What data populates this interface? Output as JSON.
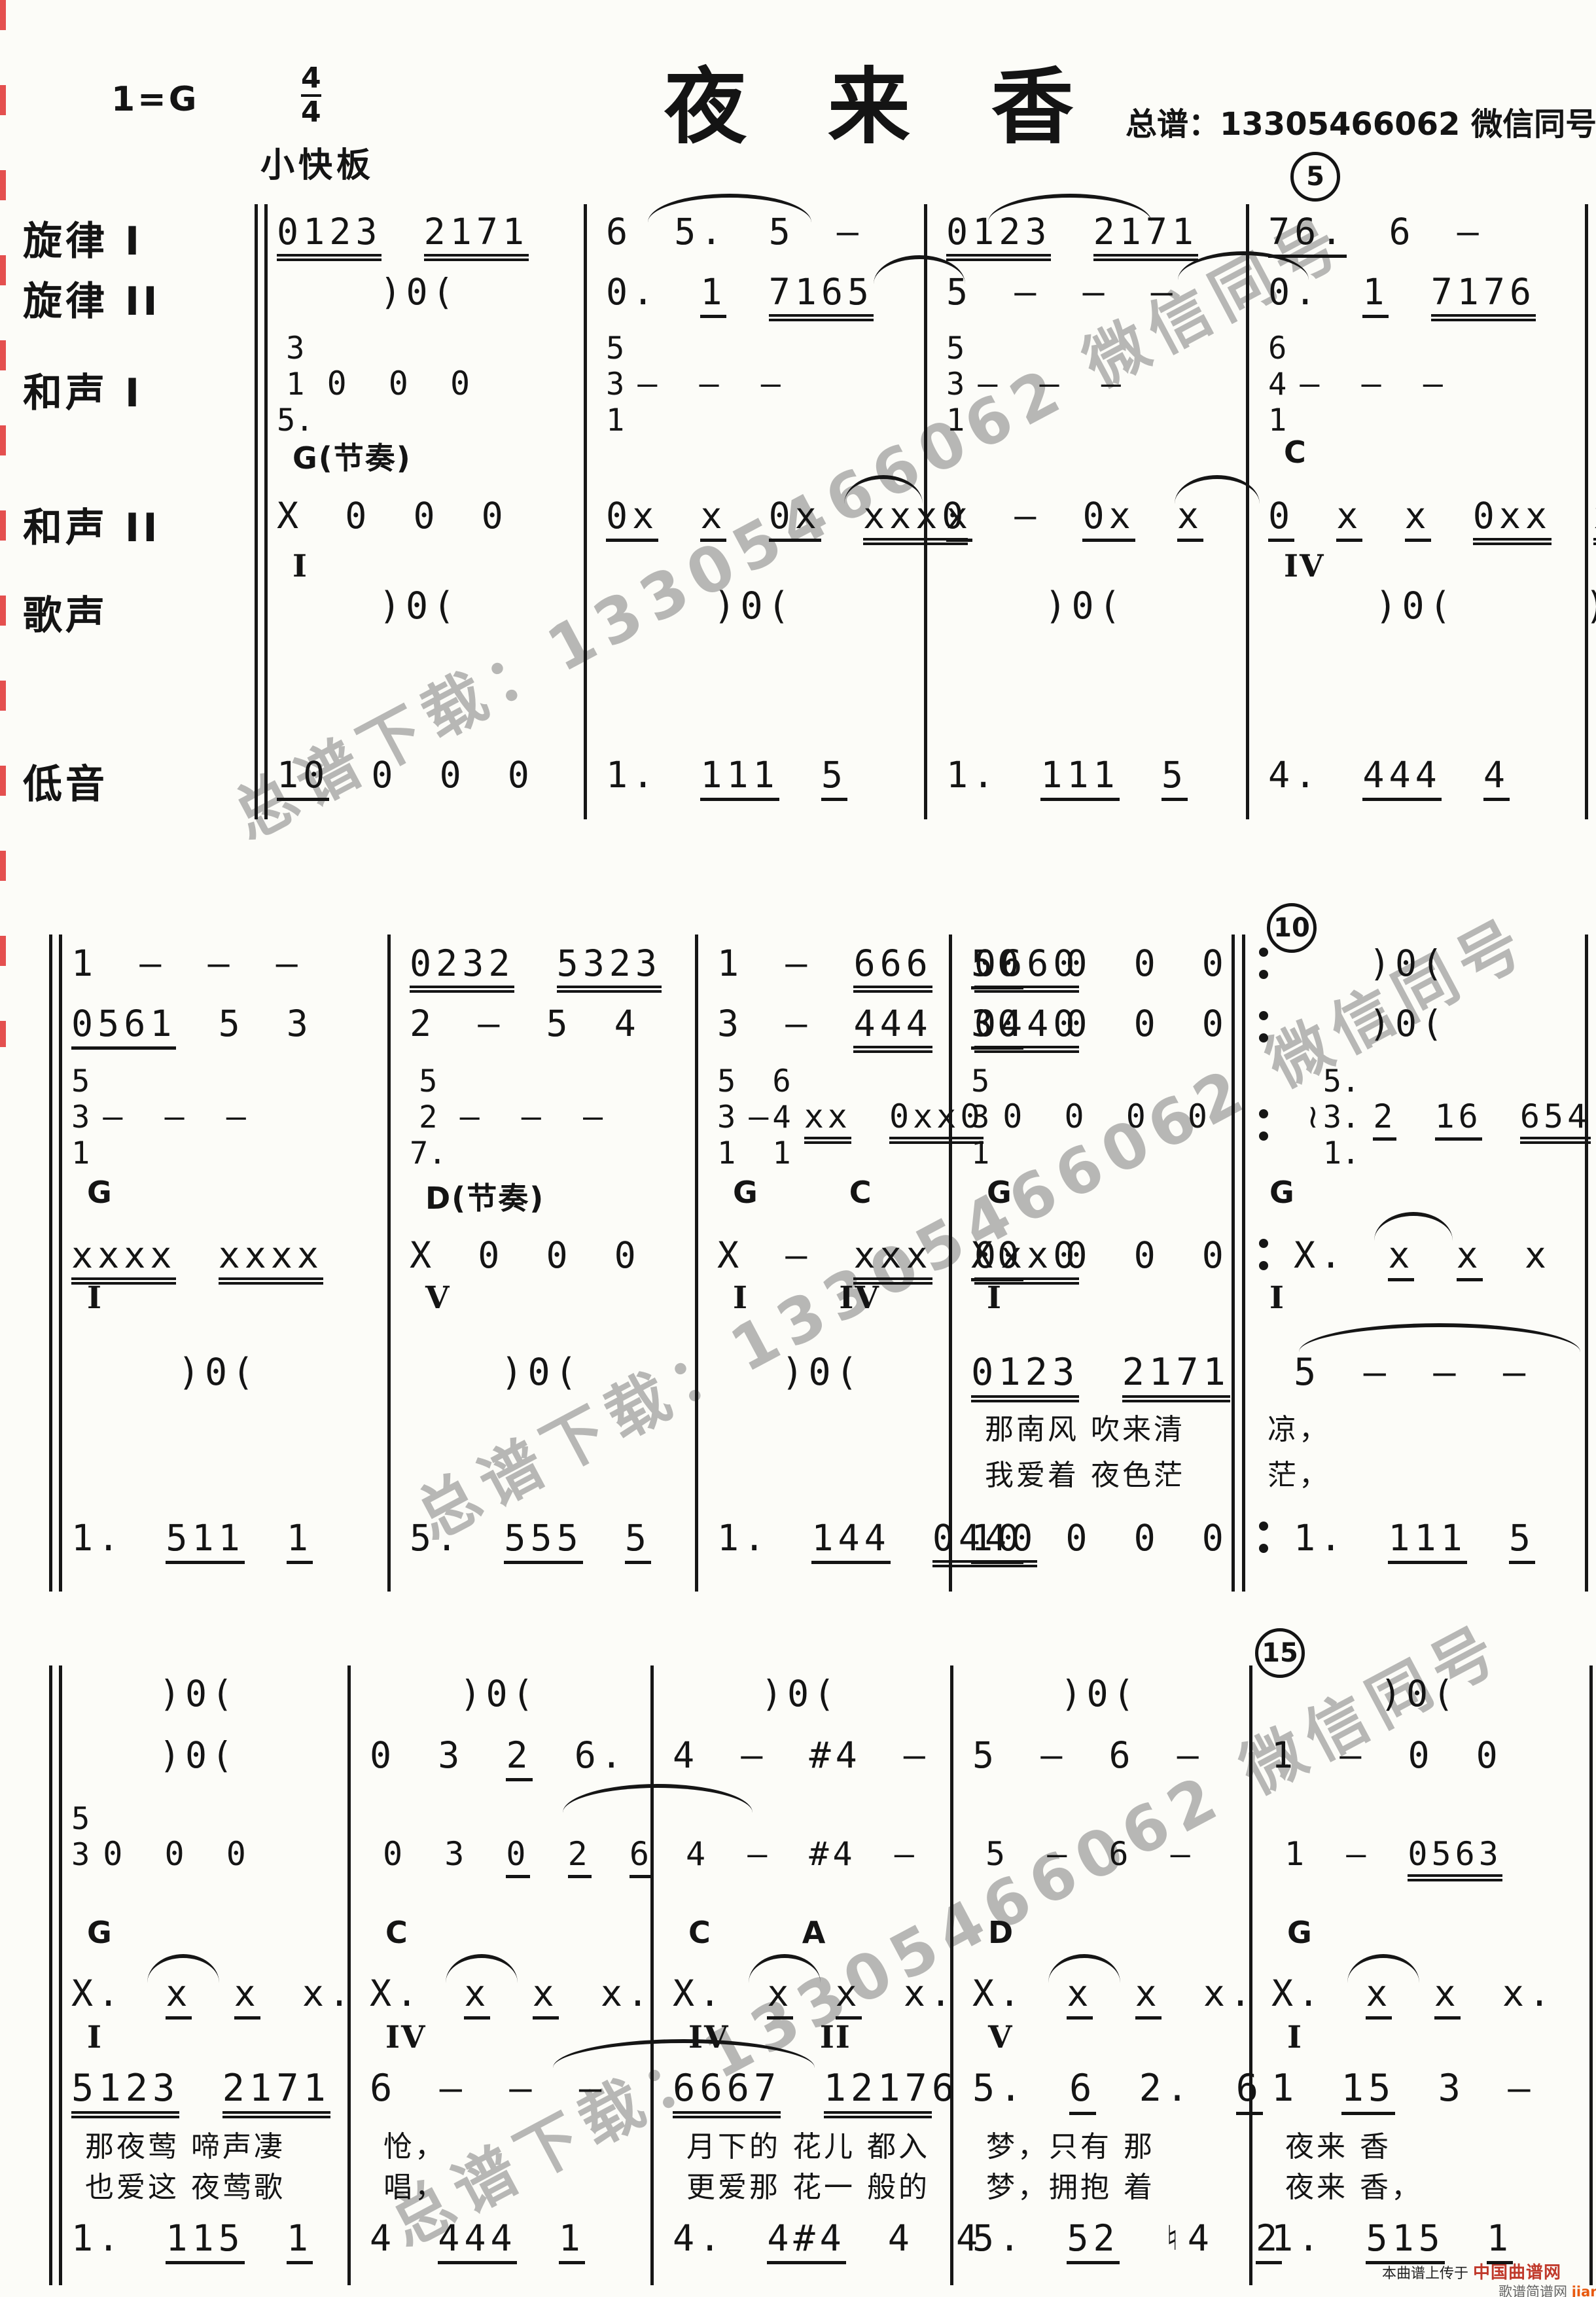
{
  "header": {
    "key": "1=G",
    "time_top": "4",
    "time_bottom": "4",
    "title": "夜 来 香",
    "contact": "总谱：13305466062  微信同号",
    "tempo": "小快板"
  },
  "labels": [
    "旋律 I",
    "旋律 II",
    "和声 I",
    "和声 II",
    "歌声",
    "低音"
  ],
  "measure_numbers": [
    "5",
    "10",
    "15"
  ],
  "watermark": "总谱下载：13305466062 微信同号",
  "footer": {
    "line1": "本曲谱上传于",
    "logo": "中国曲谱网",
    "line2": "歌谱简谱网",
    "site": "jianpu.cn"
  },
  "colors": {
    "ink": "#141414",
    "watermark_gray": "#7d7d7d",
    "artifact_red": "#e03131",
    "site_orange": "#e8590f",
    "logo_red": "#c0392b"
  },
  "systems": [
    {
      "measures": [
        {
          "melody1": "{0123} {2171}",
          "melody2": ")0(",
          "h1": [
            {
              "s": [
                "3",
                "1",
                "5."
              ]
            },
            {
              "t": "0  0  0"
            }
          ],
          "chord": "G(节奏)",
          "harmony2": "X 0 0 0",
          "roman": "I",
          "vocal": ")0(",
          "bass": "[10] 0 0 0"
        },
        {
          "melody1": "6 5. 5 –",
          "melody2": "0. [1] {7165}",
          "h1": [
            {
              "s": [
                "5",
                "3",
                "1"
              ]
            },
            {
              "t": "–  –  –"
            }
          ],
          "harmony2": "[0x] [x] [0x] {xxx0}",
          "vocal": ")0(",
          "bass": "1. [111] [5]"
        },
        {
          "melody1": "{0123} {2171}",
          "melody2": "5 – – –",
          "h1": [
            {
              "s": [
                "5",
                "3",
                "1"
              ]
            },
            {
              "t": "–  –  –"
            }
          ],
          "harmony2": "[x] – [0x] [x]",
          "vocal": ")0(",
          "bass": "1. [111] [5]"
        },
        {
          "melody1": "[76.] 6 –",
          "melody2": "0. [1] {7176}",
          "h1": [
            {
              "s": [
                "6",
                "4",
                "1"
              ]
            },
            {
              "t": "–  –  –"
            }
          ],
          "chord": "C",
          "harmony2": "[0] [x] [x] {0xx} {xxx}",
          "roman": "IV",
          "vocal": ")0(",
          "bass": "4. [444] [4]"
        },
        {
          "melody1": "4 – – –",
          "melody2": "[6246] [2] 6",
          "h1": [
            {
              "s": [
                "4",
                "2",
                "6."
              ]
            },
            {
              "t": "–  –  –"
            }
          ],
          "chord": "Am(分解)",
          "harmony2": "{xxxx} {xxxx}",
          "roman": "IIm",
          "vocal": ")0(",
          "bass": "2. [6222]"
        }
      ]
    },
    {
      "measures": [
        {
          "melody1": "1 – – –",
          "melody2": "[0561] 5 3",
          "h1": [
            {
              "s": [
                "5",
                "3",
                "1"
              ]
            },
            {
              "t": "–  –  –"
            }
          ],
          "chord": "G",
          "harmony2": "{xxxx} {xxxx}",
          "roman": "I",
          "vocal": ")0(",
          "bass": "1. [511] [1]"
        },
        {
          "melody1": "{0232} {5323}",
          "melody2": "2 – 5 4",
          "h1": [
            {
              "s": [
                "5",
                "2",
                "7."
              ]
            },
            {
              "t": "–  –  –"
            }
          ],
          "chord": "D(节奏)",
          "harmony2": "X 0 0 0",
          "roman": "V",
          "vocal": ")0(",
          "bass": "5. [555] [5]"
        },
        {
          "melody1": "1 – {666} {0660}",
          "melody2": "3 – {444} {0440}",
          "h1": [
            {
              "s": [
                "5",
                "3",
                "1"
              ]
            },
            {
              "t": "–"
            },
            {
              "s": [
                "6",
                "4",
                "1"
              ]
            },
            {
              "t": "{xx} {0xx0}"
            }
          ],
          "chord": "G C",
          "harmony2": "X – {xxx} {0xx0}",
          "roman": "I IV",
          "vocal": ")0(",
          "bass": "1. [144] {0440}"
        },
        {
          "melody1": "[50] 0 0 0",
          "melody2": "[30] 0 0 0",
          "h1": [
            {
              "s": [
                "5",
                "3",
                "1"
              ]
            },
            {
              "t": "0 0 0 0"
            }
          ],
          "chord": "G",
          "harmony2": "[X0] 0 0 0",
          "roman": "I",
          "vocal": "{0123} {2171}",
          "lyric1": "那南风 吹来清",
          "lyric2": "我爱着 夜色茫",
          "bass": "[10] 0 0 0"
        },
        {
          "melody1": ")0(",
          "melody2": ")0(",
          "h1": [
            {
              "t": "≀"
            },
            {
              "s": [
                "5.",
                "3.",
                "1."
              ]
            },
            {
              "t": "[2] [16] {654}"
            }
          ],
          "chord": "G",
          "harmony2": "X. [x] [x] x .",
          "roman": "I",
          "vocal": "5 – – –",
          "lyric1": "凉，",
          "lyric2": "茫，",
          "bass": "1. [111] [5]"
        }
      ]
    },
    {
      "measures": [
        {
          "melody1": ")0(",
          "melody2": ")0(",
          "h1": [
            {
              "s": [
                "5",
                "3"
              ]
            },
            {
              "t": "0  0  0"
            }
          ],
          "chord": "G",
          "harmony2": "X. [x] [x] x.",
          "roman": "I",
          "vocal": "{5123} {2171}",
          "lyric1": "那夜莺 啼声凄",
          "lyric2": "也爱这 夜莺歌",
          "bass": "1. [115] [1]"
        },
        {
          "melody1": ")0(",
          "melody2": "0 3 [2] 6.",
          "h1": [
            {
              "t": "0 3 [0] [2] [6]"
            }
          ],
          "chord": "C",
          "harmony2": "X. [x] [x] x.",
          "roman": "IV",
          "vocal": "6 – – –",
          "lyric1": "怆，",
          "lyric2": "唱，",
          "bass": "4 [444] [1]"
        },
        {
          "melody1": ")0(",
          "melody2": "4 – #4 –",
          "h1": [
            {
              "t": "4 – #4 –"
            }
          ],
          "chord": "C A",
          "harmony2": "X. [x] [x] x.",
          "roman": "IV II",
          "vocal": "{6667} {1217}6",
          "lyric1": "月下的 花儿 都入",
          "lyric2": "更爱那 花一 般的",
          "bass": "4. [4#4] 4 4"
        },
        {
          "melody1": ")0(",
          "melody2": "5 – 6 –",
          "h1": [
            {
              "t": "5 – 6 –"
            }
          ],
          "chord": "D",
          "harmony2": "X. [x] [x] x.",
          "roman": "V",
          "vocal": "5. [6] 2. [6]",
          "lyric1": "梦，只有 那",
          "lyric2": "梦，拥抱 着",
          "bass": "5. [52] ♮4 [2]"
        },
        {
          "melody1": ")0(",
          "melody2": "1 – 0 0",
          "h1": [
            {
              "t": "1 – {0563}"
            }
          ],
          "chord": "G",
          "harmony2": "X. [x] [x] x.",
          "roman": "I",
          "vocal": "1 [15] 3 –",
          "lyric1": "夜来 香",
          "lyric2": "夜来 香，",
          "bass": "1. [515] [1]"
        }
      ]
    }
  ]
}
